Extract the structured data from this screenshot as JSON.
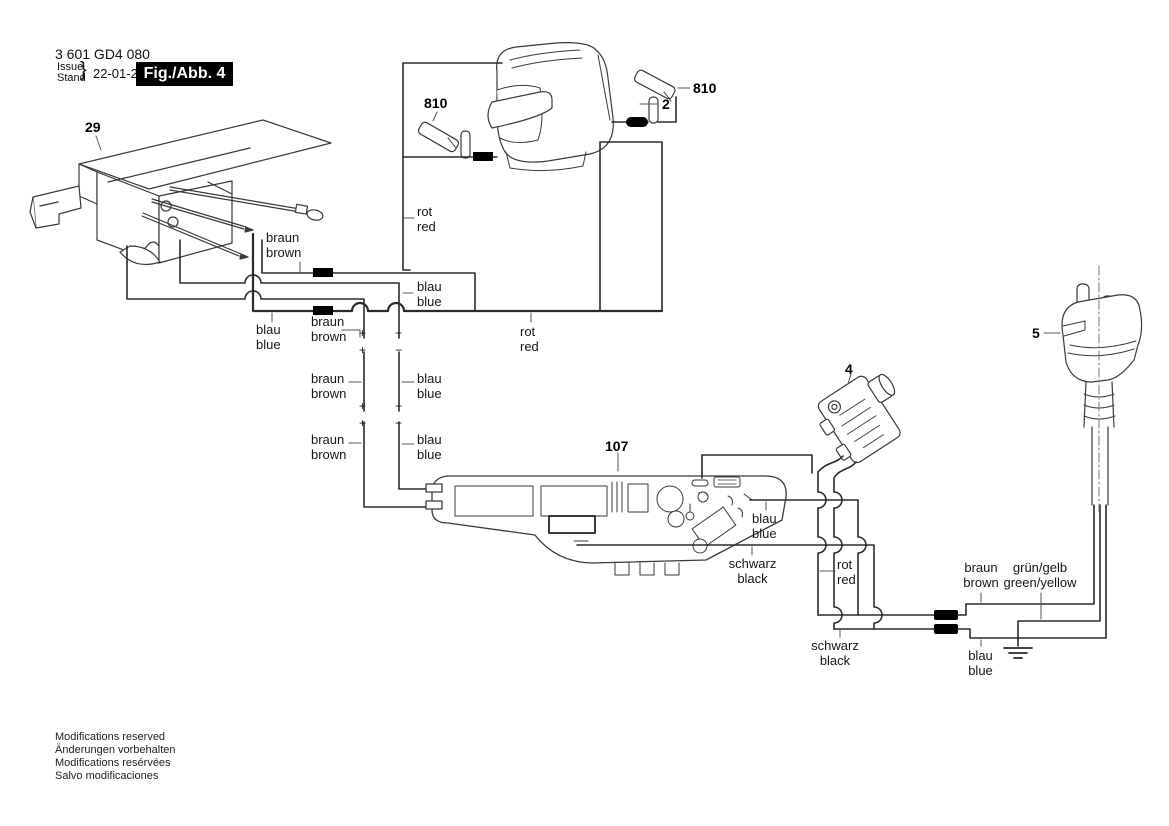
{
  "header": {
    "part_number": "3 601 GD4 080",
    "issue_label": "Issue",
    "stand_label": "Stand",
    "brace": "}",
    "date": "22-01-26",
    "figure_label": "Fig./Abb. 4"
  },
  "part_labels": {
    "switch": "29",
    "brush_left": "810",
    "field": "2",
    "brush_right": "810",
    "plug": "5",
    "suppressor": "4",
    "pcb": "107"
  },
  "wire_labels": {
    "rot_top": {
      "de": "rot",
      "en": "red"
    },
    "braun_top": {
      "de": "braun",
      "en": "brown"
    },
    "blau_top": {
      "de": "blau",
      "en": "blue"
    },
    "blau_left": {
      "de": "blau",
      "en": "blue"
    },
    "braun_mid": {
      "de": "braun",
      "en": "brown"
    },
    "rot_mid": {
      "de": "rot",
      "en": "red"
    },
    "braun_v1": {
      "de": "braun",
      "en": "brown"
    },
    "blau_v1": {
      "de": "blau",
      "en": "blue"
    },
    "braun_v2": {
      "de": "braun",
      "en": "brown"
    },
    "blau_v2": {
      "de": "blau",
      "en": "blue"
    },
    "blau_pcb": {
      "de": "blau",
      "en": "blue"
    },
    "schwarz_pcb": {
      "de": "schwarz",
      "en": "black"
    },
    "rot_bottom": {
      "de": "rot",
      "en": "red"
    },
    "schwarz_bottom": {
      "de": "schwarz",
      "en": "black"
    },
    "braun_plug": {
      "de": "braun",
      "en": "brown"
    },
    "gruen_gelb": {
      "de": "grün/gelb",
      "en": "green/yellow"
    },
    "blau_plug": {
      "de": "blau",
      "en": "blue"
    }
  },
  "symbols": {
    "plus": "+",
    "minus": "−"
  },
  "colors": {
    "line": "#2b2b2b",
    "figure_box_bg": "#000000",
    "figure_box_text": "#ffffff",
    "background": "#ffffff"
  },
  "footer": {
    "line1": "Modifications reserved",
    "line2": "Änderungen vorbehalten",
    "line3": "Modifications resérvées",
    "line4": "Salvo modificaciones"
  }
}
